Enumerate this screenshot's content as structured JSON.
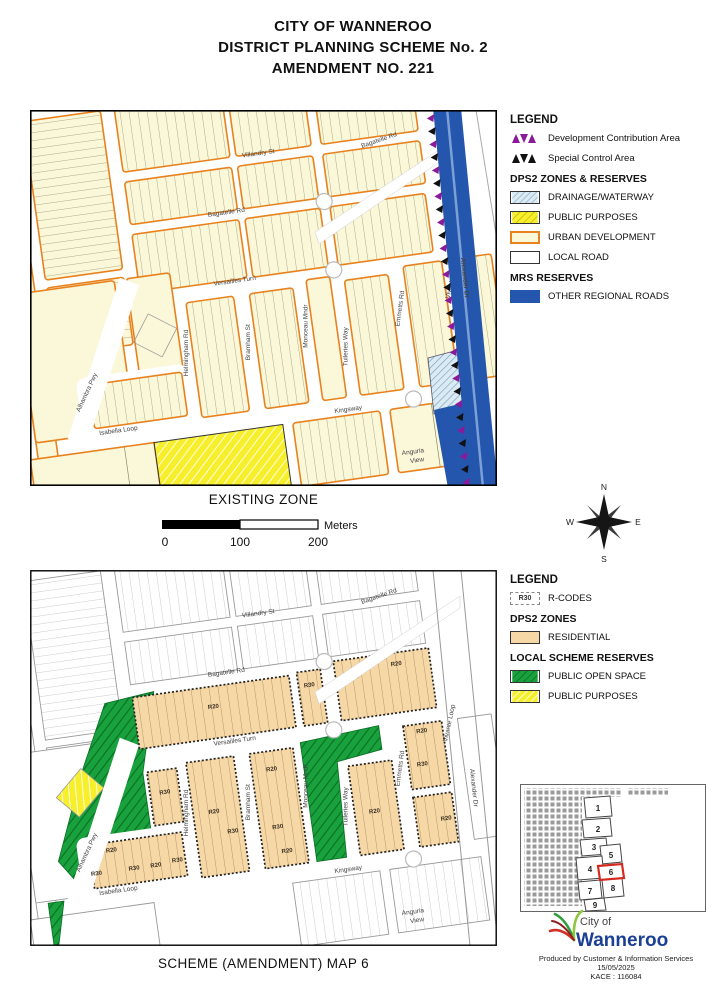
{
  "title": {
    "line1": "CITY OF WANNEROO",
    "line2": "DISTRICT PLANNING SCHEME No. 2",
    "line3": "AMENDMENT NO. 221"
  },
  "existing_map": {
    "caption": "EXISTING ZONE",
    "legend": {
      "heading": "LEGEND",
      "items": [
        {
          "label": "Development Contribution Area",
          "symbol": "dca-purple-triangles"
        },
        {
          "label": "Special Control Area",
          "symbol": "sca-black-triangles"
        }
      ],
      "group1_heading": "DPS2 ZONES & RESERVES",
      "group1_items": [
        {
          "label": "DRAINAGE/WATERWAY",
          "swatch": "blue-hatch"
        },
        {
          "label": "PUBLIC PURPOSES",
          "swatch": "yellow-hatch"
        },
        {
          "label": "URBAN DEVELOPMENT",
          "swatch": "cream-orange-border"
        },
        {
          "label": "LOCAL ROAD",
          "swatch": "white"
        }
      ],
      "group2_heading": "MRS RESERVES",
      "group2_items": [
        {
          "label": "OTHER REGIONAL ROADS",
          "swatch": "blue"
        }
      ]
    }
  },
  "scheme_map": {
    "caption": "SCHEME (AMENDMENT) MAP 6",
    "legend": {
      "heading": "LEGEND",
      "rcodes_label": "R-CODES",
      "rcodes_chip": "R30",
      "group1_heading": "DPS2 ZONES",
      "group1_items": [
        {
          "label": "RESIDENTIAL",
          "swatch": "peach"
        }
      ],
      "group2_heading": "LOCAL SCHEME RESERVES",
      "group2_items": [
        {
          "label": "PUBLIC OPEN SPACE",
          "swatch": "green-hatch"
        },
        {
          "label": "PUBLIC PURPOSES",
          "swatch": "yellow-hatch"
        }
      ]
    }
  },
  "streets": {
    "monticello": "Monticello Mndr",
    "villandry": "Villandry St",
    "bagatelle": "Bagatelle Rd",
    "versailles": "Versailles Turn",
    "alhambra": "Alhambra Pwy",
    "helmingham": "Helmingham Rd",
    "bramham": "Bramham St",
    "monceau": "Monceau Mndr",
    "tuileries": "Tuileries Way",
    "emmetts": "Emmetts Rd",
    "vivante": "Vivante Loop",
    "isabella": "Isabella Loop",
    "kingsway": "Kingsway",
    "anguria_line1": "Anguria",
    "anguria_line2": "View",
    "alexander": "Alexander Dr"
  },
  "rcodes": {
    "r20": "R20",
    "r30": "R30"
  },
  "scalebar": {
    "t0": "0",
    "t1": "100",
    "t2": "200",
    "unit": "Meters"
  },
  "compass": {
    "n": "N",
    "e": "E",
    "s": "S",
    "w": "W"
  },
  "locator": {
    "sheets": [
      "1",
      "2",
      "3",
      "4",
      "5",
      "6",
      "7",
      "8",
      "9"
    ],
    "highlighted": "6"
  },
  "footer": {
    "brand_top": "City of",
    "brand_name": "Wanneroo",
    "produced": "Produced by Customer & Information Services",
    "date": "15/05/2025",
    "ref": "KACE : 116084"
  },
  "colors": {
    "urban_fill": "#FBF7D9",
    "urban_border": "#E8821F",
    "regional_road_blue": "#2456AE",
    "residential_fill": "#F6D7A6",
    "public_open_space_green": "#18A13C",
    "public_purposes_yellow": "#F7EF2B",
    "drainage_blue": "#DCEAF3",
    "dca_purple": "#8B1A9B",
    "sca_black": "#111111",
    "logo_blue": "#1B3F94",
    "locator_highlight_red": "#D42A20"
  }
}
